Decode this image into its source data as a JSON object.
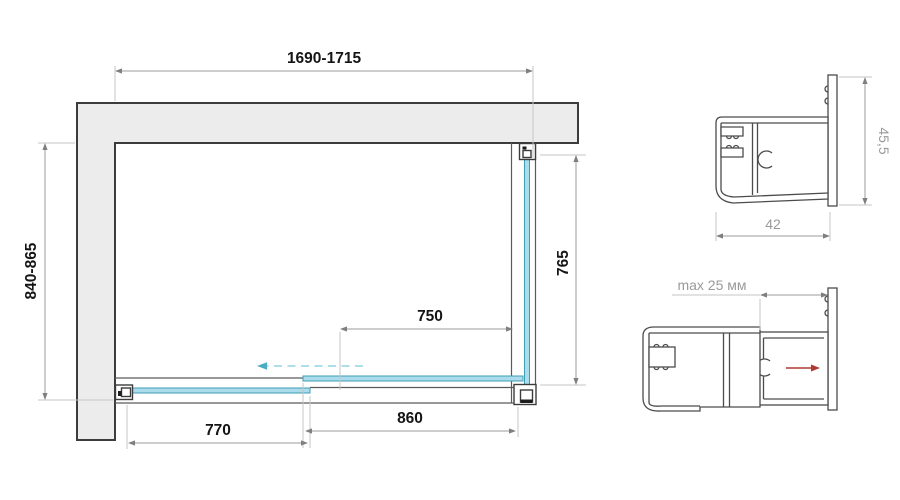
{
  "title": "Shower enclosure installation dimensions drawing",
  "plan": {
    "dim_width": "1690-1715",
    "dim_depth": "840-865",
    "dim_side": "765",
    "dim_opening": "750",
    "dim_fixed": "860",
    "dim_door": "770"
  },
  "profile_top": {
    "dim_height": "45,5",
    "dim_width": "42"
  },
  "profile_bottom": {
    "dim_adjust": "max 25 мм"
  },
  "colors": {
    "glass_fill": "#aadcec",
    "glass_stroke": "#3f9db5",
    "wall_fill": "#ececec",
    "wall_stroke": "#3c3c3c",
    "dim_line": "#9b9b9b",
    "dim_text": "#151515",
    "detail_text": "#9a9a9a",
    "outline": "#4c4c4c",
    "arrow_red": "#b03a33",
    "arrow_cyan": "#4aabc3"
  }
}
